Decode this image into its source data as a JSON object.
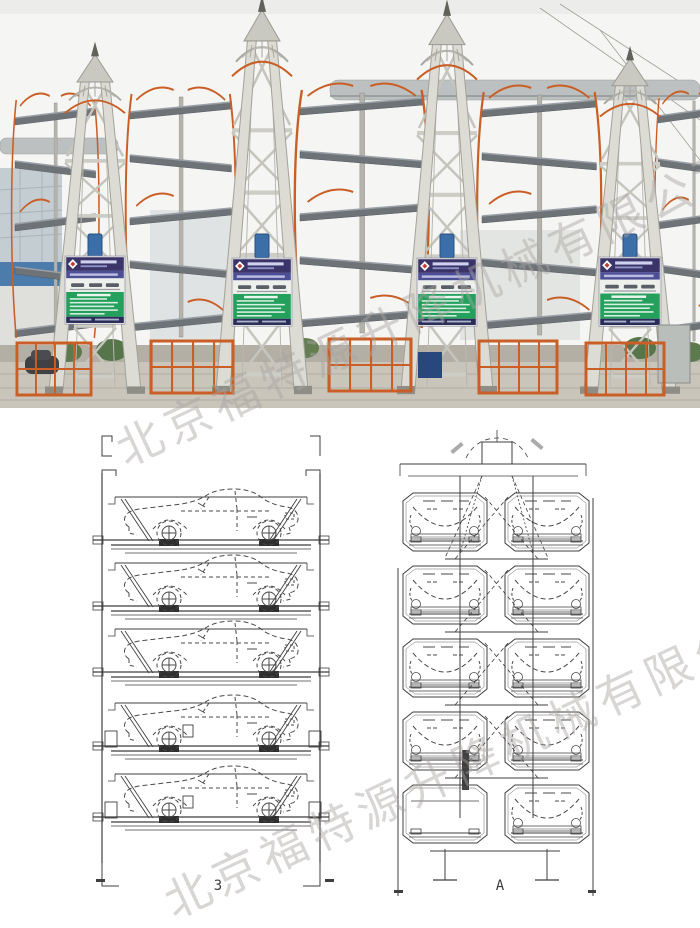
{
  "photo": {
    "tower_count": 4,
    "colors": {
      "steel": "#dcdcd4",
      "steel_shadow": "#a2a29a",
      "accent_orange": "#c95f26",
      "pallet_gray": "#6e7378",
      "sign_header_blue": "#3a3468",
      "sign_green": "#23a05c",
      "building_band_blue": "#4c7cab",
      "motor_blue": "#3c6fa8",
      "ground": "#c9c5bb"
    }
  },
  "drawings": {
    "left": {
      "label": "3"
    },
    "right": {
      "label": "A"
    }
  },
  "watermark": {
    "text": "北京福特源升降机械有限公司",
    "color": "#b5b3b0"
  }
}
